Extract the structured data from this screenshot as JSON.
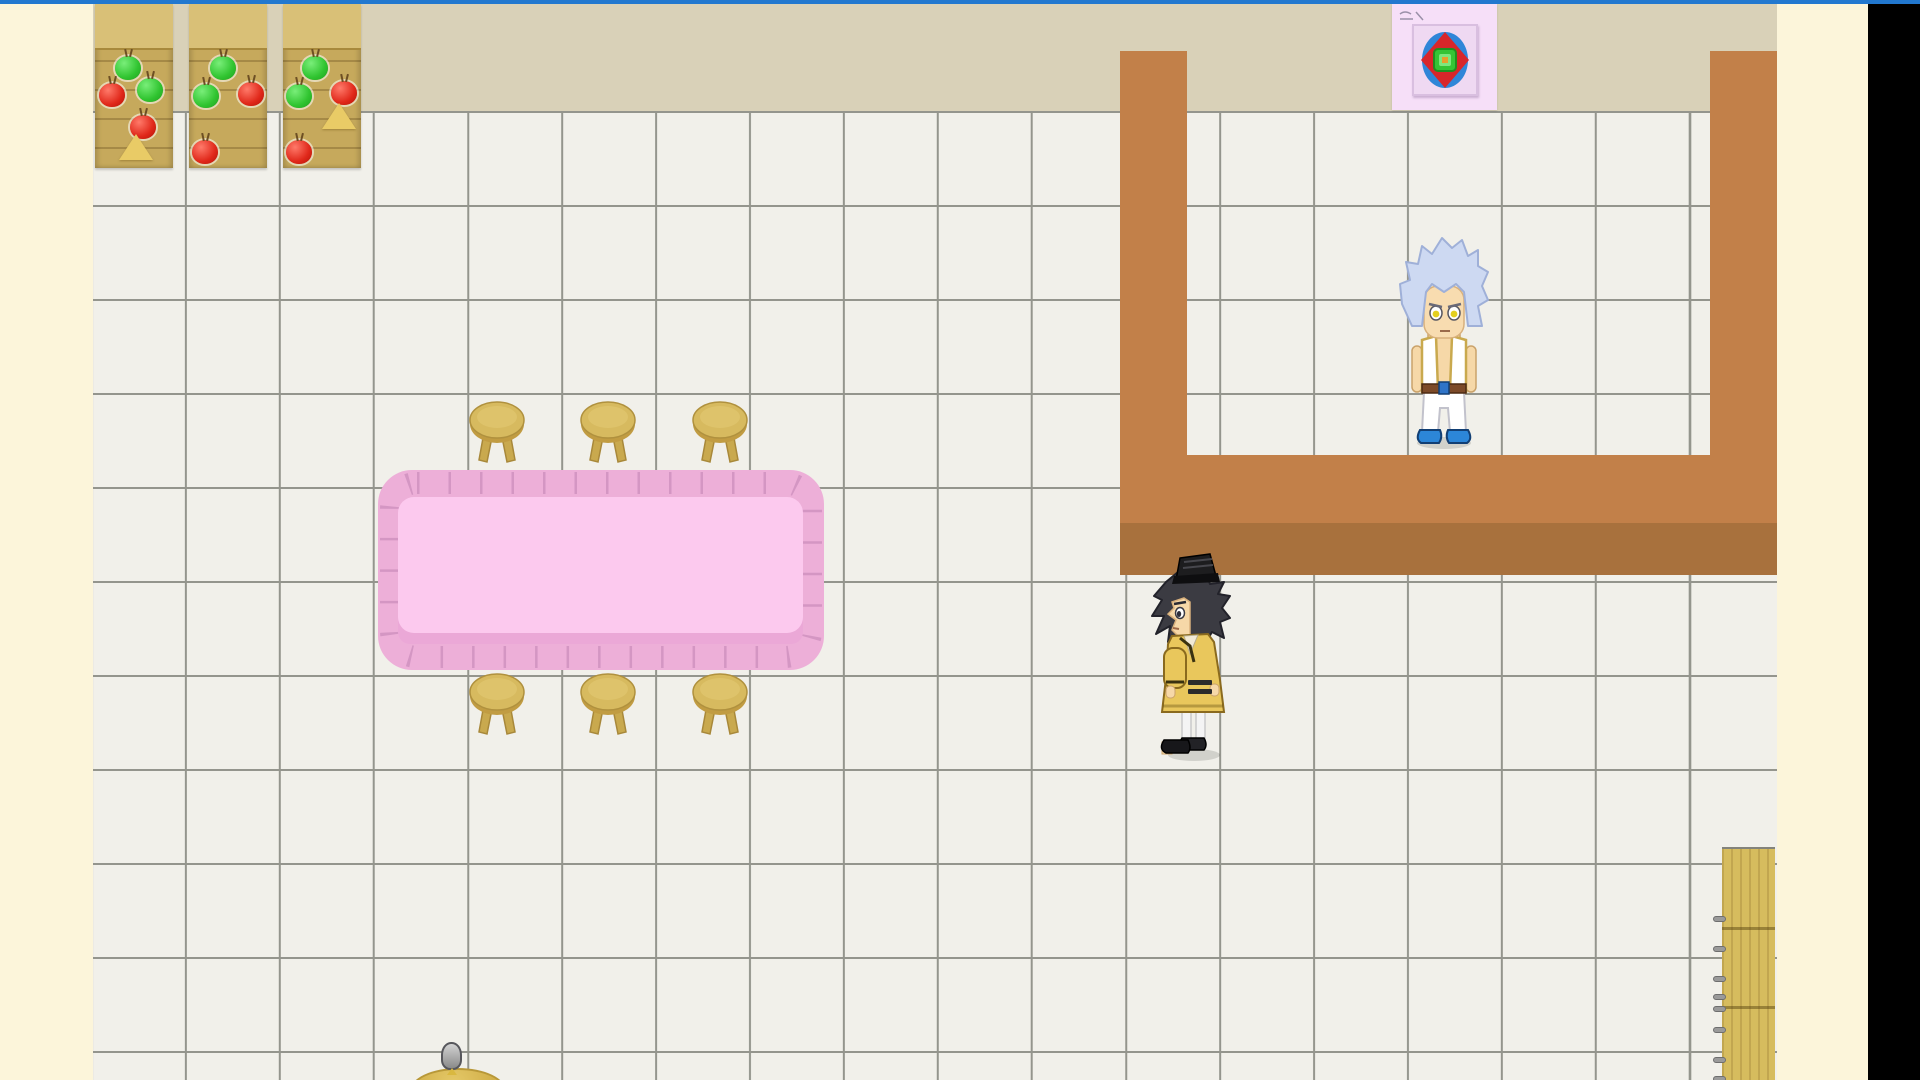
{
  "scene": {
    "description": "Top-down 2D RPG interior room: white tiled floor, beige upper wall, three wooden fruit stands, a pink ruffled dining table with six wooden stools, a brown U-shaped partition wall, a poster on the wall, a wooden plank shelf, and three characters",
    "viewport": {
      "width": 1920,
      "height": 1080
    },
    "visible_text": "none (only an illegible tiny scribble on the poster)"
  },
  "colors": {
    "blue-strip": "#2278cf",
    "side-band": "#fcf5da",
    "black-bar": "#000000",
    "top-wall": "#d9d1b8",
    "floor": "#f1f0ea",
    "grid-line": "#94958d",
    "wall-brown": "#c28049",
    "wall-brown-dark": "#a8713d",
    "shelf-wood": "#c6a95c",
    "shelf-wood-top": "#d9c077",
    "apple-green": "#30c430",
    "apple-red": "#e0281a",
    "cheese-yellow": "#e9cb66",
    "stool-wood": "#d7ba5f",
    "table-ruffle": "#edafd8",
    "table-top": "#fcc9ee",
    "table-pleat": "#cf92bf",
    "poster-bg": "#f6dff8",
    "ladder-wood": "#d6bc5e"
  },
  "grid": {
    "tile_px": 94,
    "origin_x": 91,
    "origin_y": 111,
    "line_px": 2
  },
  "shelves": [
    {
      "x": 95,
      "fruits": [
        {
          "kind": "apple-green",
          "x": 20,
          "y": 52
        },
        {
          "kind": "apple-red",
          "x": 4,
          "y": 79
        },
        {
          "kind": "apple-green",
          "x": 42,
          "y": 74
        },
        {
          "kind": "apple-red",
          "x": 35,
          "y": 111
        },
        {
          "kind": "cheese-wedge",
          "x": 24,
          "y": 130
        }
      ]
    },
    {
      "x": 189,
      "fruits": [
        {
          "kind": "apple-green",
          "x": 21,
          "y": 52
        },
        {
          "kind": "apple-green",
          "x": 4,
          "y": 80
        },
        {
          "kind": "apple-red",
          "x": 49,
          "y": 78
        },
        {
          "kind": "apple-red",
          "x": 3,
          "y": 136
        }
      ]
    },
    {
      "x": 283,
      "fruits": [
        {
          "kind": "apple-green",
          "x": 19,
          "y": 52
        },
        {
          "kind": "apple-green",
          "x": 3,
          "y": 80
        },
        {
          "kind": "apple-red",
          "x": 48,
          "y": 77
        },
        {
          "kind": "cheese-wedge",
          "x": 39,
          "y": 99
        },
        {
          "kind": "apple-red",
          "x": 3,
          "y": 136
        }
      ]
    }
  ],
  "table": {
    "x": 378,
    "y": 470,
    "width": 446,
    "height": 200,
    "style": "pink ruffled tablecloth, lighter pink top"
  },
  "stools": {
    "count": 6,
    "positions": [
      [
        467,
        400
      ],
      [
        578,
        400
      ],
      [
        690,
        400
      ],
      [
        467,
        672
      ],
      [
        578,
        672
      ],
      [
        690,
        672
      ]
    ]
  },
  "walls": {
    "left_column": {
      "x": 1120,
      "y": 51,
      "w": 67,
      "h": 472
    },
    "right_column": {
      "x": 1710,
      "y": 51,
      "w": 67,
      "h": 472
    },
    "crossbar": {
      "x": 1120,
      "y": 455,
      "w": 657,
      "h": 68
    },
    "crossbar_shadow": {
      "x": 1120,
      "y": 523,
      "w": 657,
      "h": 52
    }
  },
  "poster": {
    "x": 1392,
    "y": 4,
    "width": 105,
    "height": 106,
    "art": "framed blue oval with red four-point star and green-orange center"
  },
  "ladder": {
    "x": 1722,
    "y": 847,
    "width": 53,
    "height": 233,
    "peg_offsets": [
      67,
      97,
      127,
      145,
      157,
      178,
      208,
      227
    ]
  },
  "characters": [
    {
      "id": "character-white-hair",
      "x": 1398,
      "y": 234,
      "facing": "down",
      "appearance": "spiky pale-blue hair, yellow eyes, open white vest with gold trim, bare chest, brown belt with blue buckle, white pants, blue shoes"
    },
    {
      "id": "character-yellow-robe",
      "x": 1150,
      "y": 546,
      "facing": "left",
      "appearance": "black tokin hat, dark spiky hair, yellow kimono robe with black trim stripes, white socks, black shoes"
    },
    {
      "id": "seated-figure-group",
      "x": 410,
      "y": 1042,
      "appearance": "gray-haired figure seated at a round wooden table, clipped by bottom screen edge"
    }
  ],
  "placements": {
    "character-white-hair": [
      1398,
      234
    ],
    "character-yellow-robe": [
      1150,
      546
    ],
    "seated-figure-group": [
      410,
      1042
    ],
    "poster": [
      1392,
      4
    ],
    "dining-table": [
      378,
      470
    ],
    "wooden-plank-shelf": [
      1722,
      847
    ]
  }
}
